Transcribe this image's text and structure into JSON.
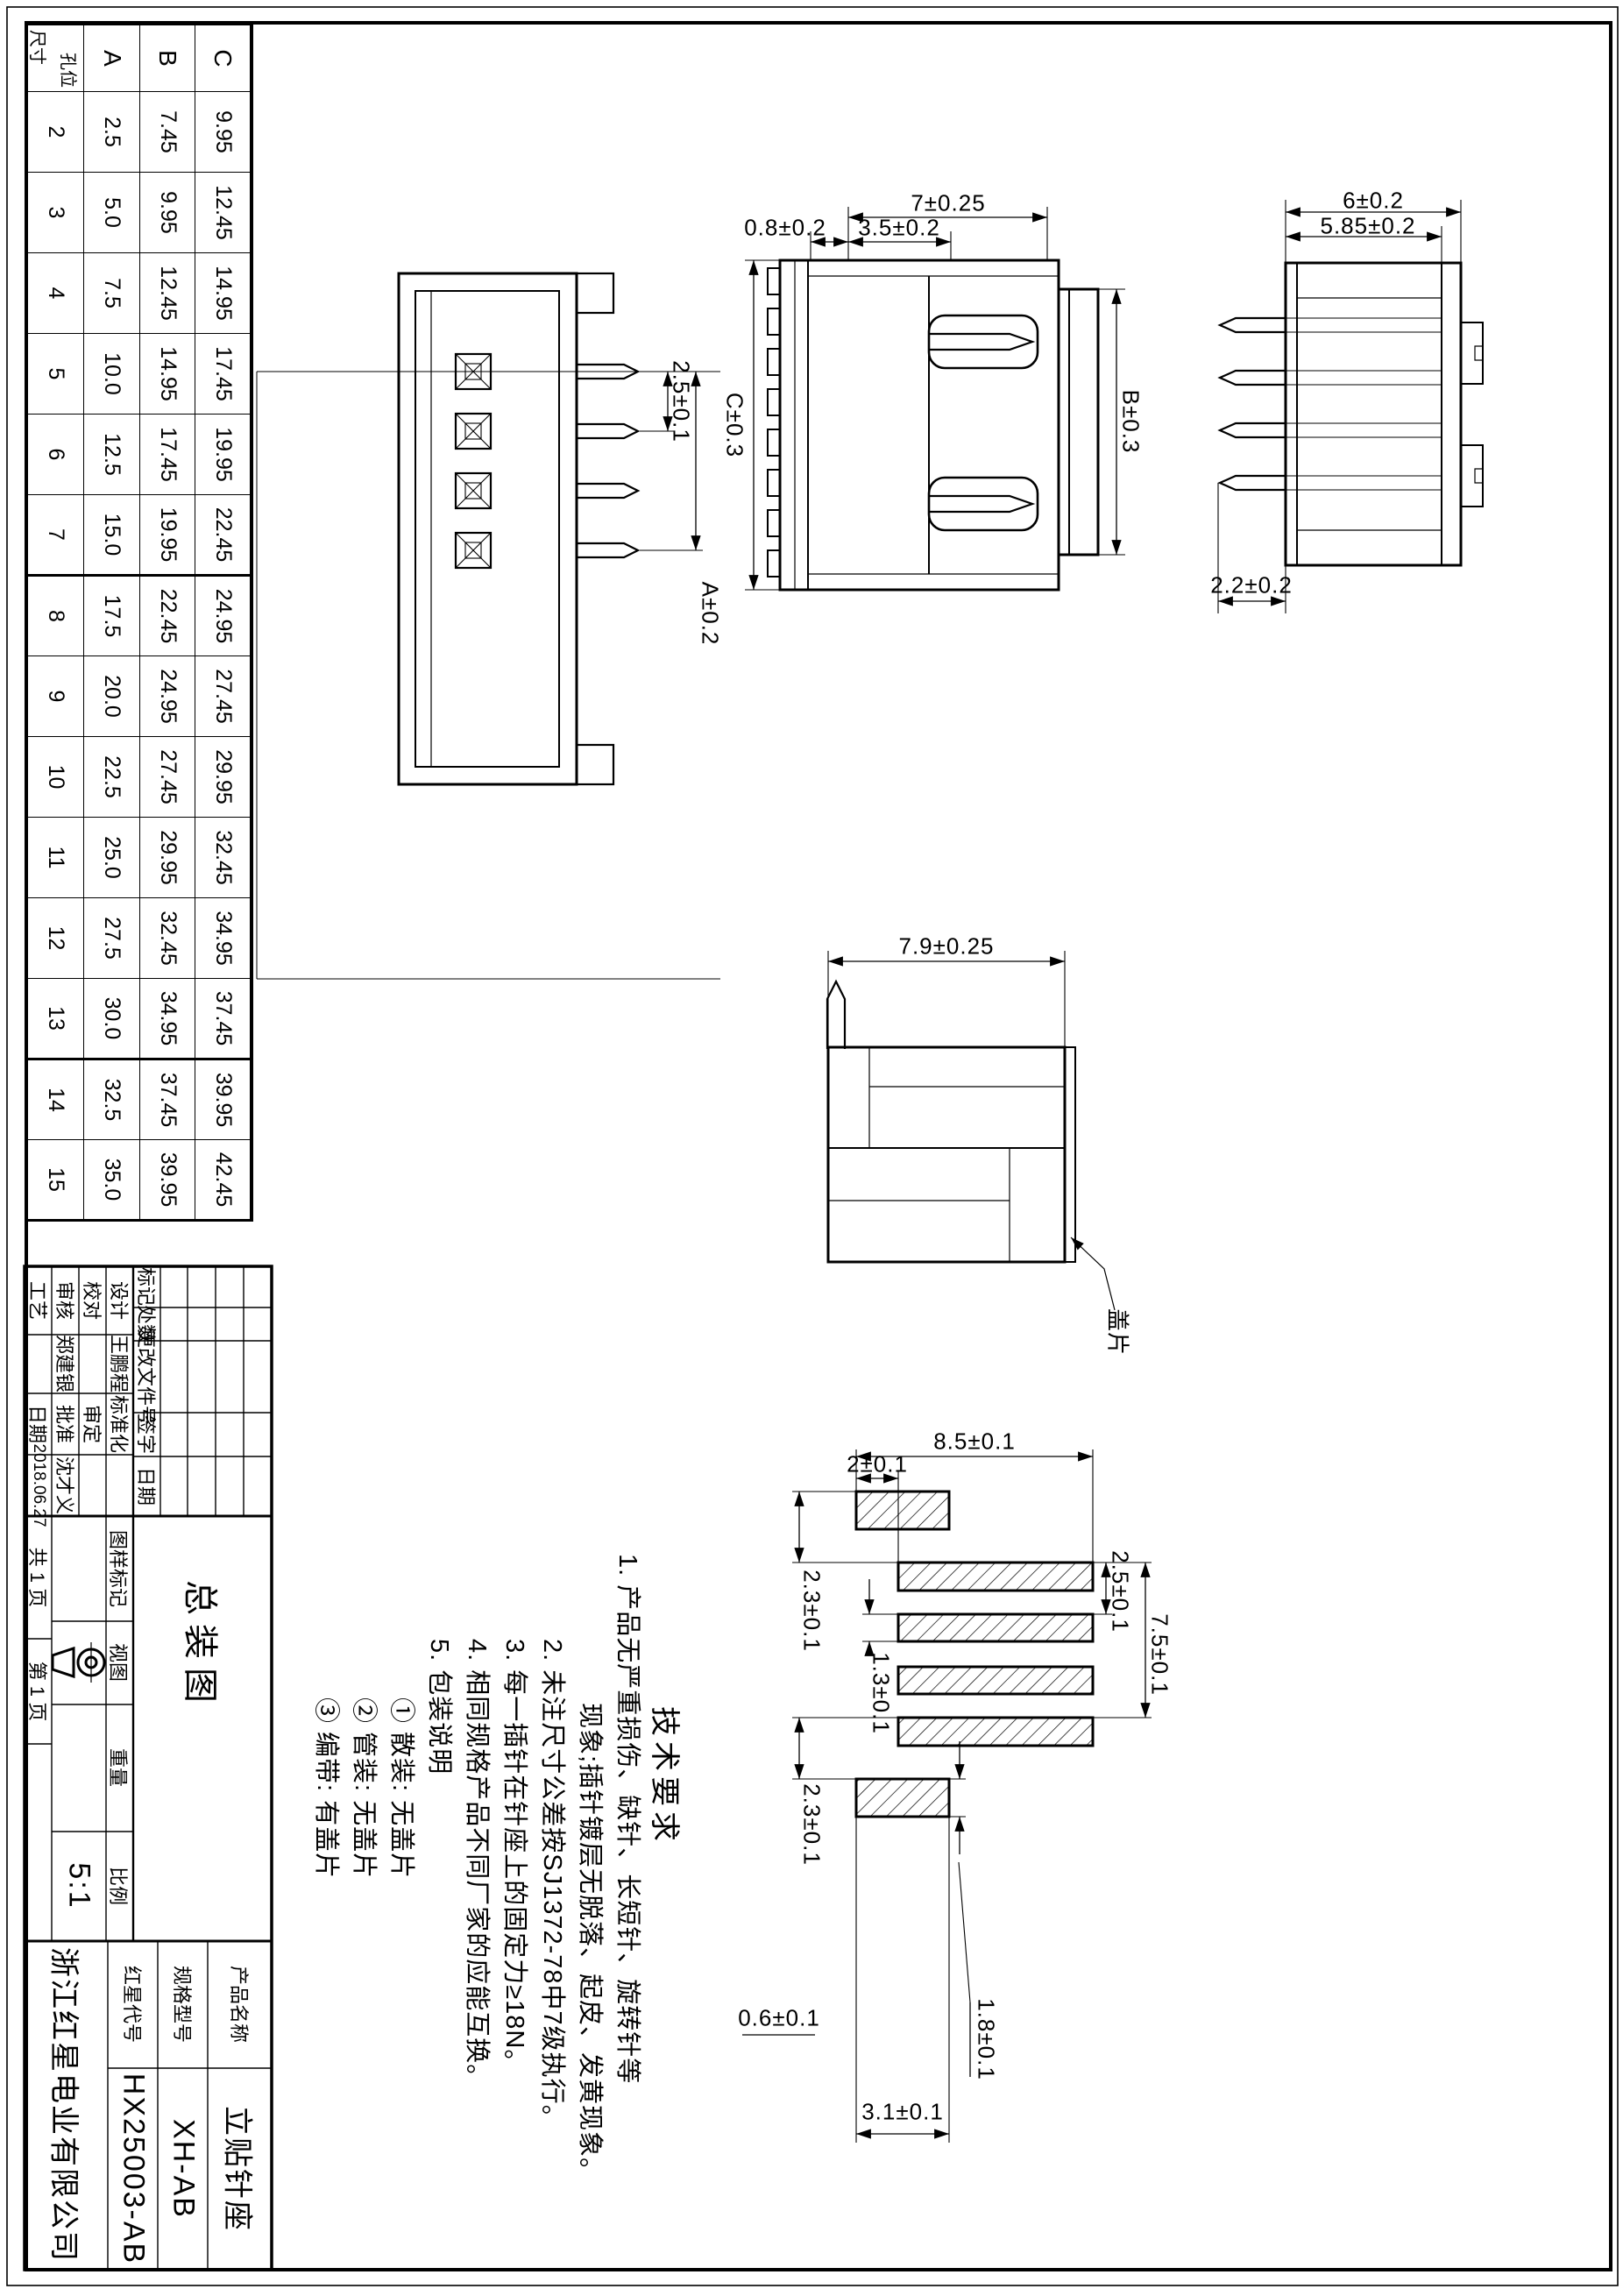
{
  "dims_table": {
    "corner_top": "尺寸",
    "corner_bottom": "孔位",
    "row_c_label": "C",
    "row_b_label": "B",
    "row_a_label": "A",
    "columns": [
      "2",
      "3",
      "4",
      "5",
      "6",
      "7",
      "8",
      "9",
      "10",
      "11",
      "12",
      "13",
      "14",
      "15"
    ],
    "row_c": [
      "9.95",
      "12.45",
      "14.95",
      "17.45",
      "19.95",
      "22.45",
      "24.95",
      "27.45",
      "29.95",
      "32.45",
      "34.95",
      "37.45",
      "39.95",
      "42.45"
    ],
    "row_b": [
      "7.45",
      "9.95",
      "12.45",
      "14.95",
      "17.45",
      "19.95",
      "22.45",
      "24.95",
      "27.45",
      "29.95",
      "32.45",
      "34.95",
      "37.45",
      "39.95"
    ],
    "row_a": [
      "2.5",
      "5.0",
      "7.5",
      "10.0",
      "12.5",
      "15.0",
      "17.5",
      "20.0",
      "22.5",
      "25.0",
      "27.5",
      "30.0",
      "32.5",
      "35.0"
    ]
  },
  "tech": {
    "title": "技术要求",
    "lines": [
      "1. 产品无严重损伤、缺针、长短针、旋转针等",
      "现象;插针镀层无脱落、起皮、发黄现象。",
      "2. 未注尺寸公差按SJ1372-78中7级执行。",
      "3. 每一插针在针座上的固定力≥18N。",
      "4. 相同规格产品不同厂家的应能互换。",
      "5. 包装说明",
      "① 散装: 无盖片",
      "② 管装: 无盖片",
      "③ 编带: 有盖片"
    ]
  },
  "dims": {
    "a_overall": "6±0.2",
    "a_body": "5.85±0.2",
    "a_pin": "2.2±0.2",
    "b_height": "7±0.25",
    "b_depth": "3.5±0.2",
    "b_lip": "0.8±0.2",
    "b_width_top": "B±0.3",
    "b_width_bottom": "C±0.3",
    "c_pitch": "2.5±0.1",
    "c_span": "A±0.2",
    "d_depth": "7.9±0.25",
    "d_cover": "盖片",
    "e_length": "8.5±0.1",
    "e_offset": "2±0.1",
    "e_gap_left": "2.3±0.1",
    "e_gap_right": "2.3±0.1",
    "e_pitch": "2.5±0.1",
    "e_span": "7.5±0.1",
    "e_pad_width": "1.3±0.1",
    "e_note": "0.6±0.1",
    "e_mount_len": "3.1±0.1",
    "e_mount_wid": "1.8±0.1"
  },
  "title_block": {
    "rev_headers": [
      "标记",
      "处数",
      "更改文件号",
      "签字",
      "日期"
    ],
    "sig": {
      "design_label": "设计",
      "design_name": "王鹏程",
      "check_label": "校对",
      "review_label": "审核",
      "review_name": "郑建银",
      "process_label": "工艺",
      "std_label": "标准化",
      "approve2_label": "审定",
      "approve_label": "批准",
      "approve_name": "沈才义",
      "date_label": "日期",
      "date_value": "2018.06.27"
    },
    "mid": {
      "mark_label": "图样标记",
      "view_label": "视图",
      "weight_label": "重量",
      "scale_label": "比例",
      "scale_value": "5:1",
      "doc_name": "总装图",
      "pages_total": "共 1 页",
      "page_num": "第 1 页"
    },
    "right": {
      "product_label": "产品名称",
      "product_value": "立贴针座",
      "spec_label": "规格型号",
      "spec_value": "XH-AB",
      "code_label": "红星代号",
      "code_value": "HX25003-AB",
      "company": "浙江红星电业有限公司"
    }
  }
}
